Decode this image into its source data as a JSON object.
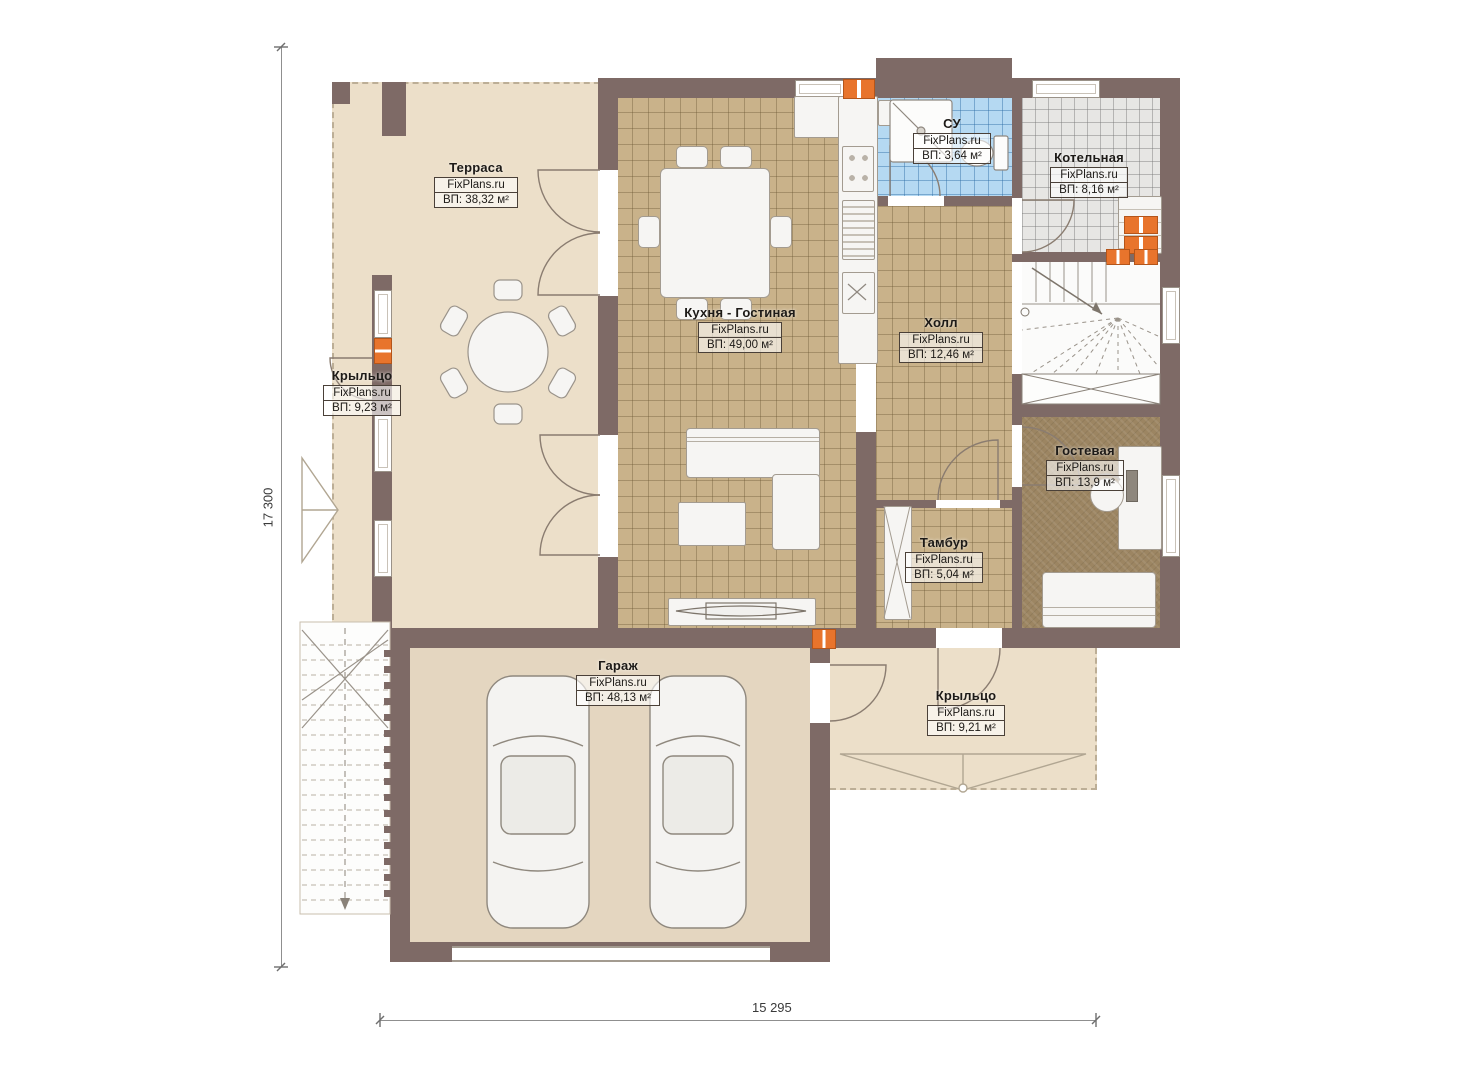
{
  "plan": {
    "title": "План 1 этажа",
    "brand": "FixPlans.ru",
    "rooms": [
      {
        "id": "terrace",
        "name": "Терраса",
        "brand": "FixPlans.ru",
        "area": "ВП: 38,32 м²"
      },
      {
        "id": "porch-left",
        "name": "Крыльцо",
        "brand": "FixPlans.ru",
        "area": "ВП: 9,23 м²"
      },
      {
        "id": "kitchen-living",
        "name": "Кухня - Гостиная",
        "brand": "FixPlans.ru",
        "area": "ВП: 49,00 м²"
      },
      {
        "id": "bathroom",
        "name": "СУ",
        "brand": "FixPlans.ru",
        "area": "ВП: 3,64 м²"
      },
      {
        "id": "boiler",
        "name": "Котельная",
        "brand": "FixPlans.ru",
        "area": "ВП: 8,16 м²"
      },
      {
        "id": "hall",
        "name": "Холл",
        "brand": "FixPlans.ru",
        "area": "ВП: 12,46 м²"
      },
      {
        "id": "guest",
        "name": "Гостевая",
        "brand": "FixPlans.ru",
        "area": "ВП: 13,9 м²"
      },
      {
        "id": "vestibule",
        "name": "Тамбур",
        "brand": "FixPlans.ru",
        "area": "ВП: 5,04 м²"
      },
      {
        "id": "garage",
        "name": "Гараж",
        "brand": "FixPlans.ru",
        "area": "ВП: 48,13 м²"
      },
      {
        "id": "porch-bottom",
        "name": "Крыльцо",
        "brand": "FixPlans.ru",
        "area": "ВП: 9,21 м²"
      }
    ],
    "dimensions": {
      "height_mm": "17 300",
      "width_mm": "15 295"
    },
    "colors": {
      "wall": "#7e6a66",
      "floor_beige": "#ecdfc9",
      "tile_tan": "#c9b28a",
      "tile_blue": "#b5d9f2",
      "tile_gray": "#e7e6e4",
      "floor_guest": "#9c8562",
      "vent_orange": "#e8742c"
    }
  }
}
